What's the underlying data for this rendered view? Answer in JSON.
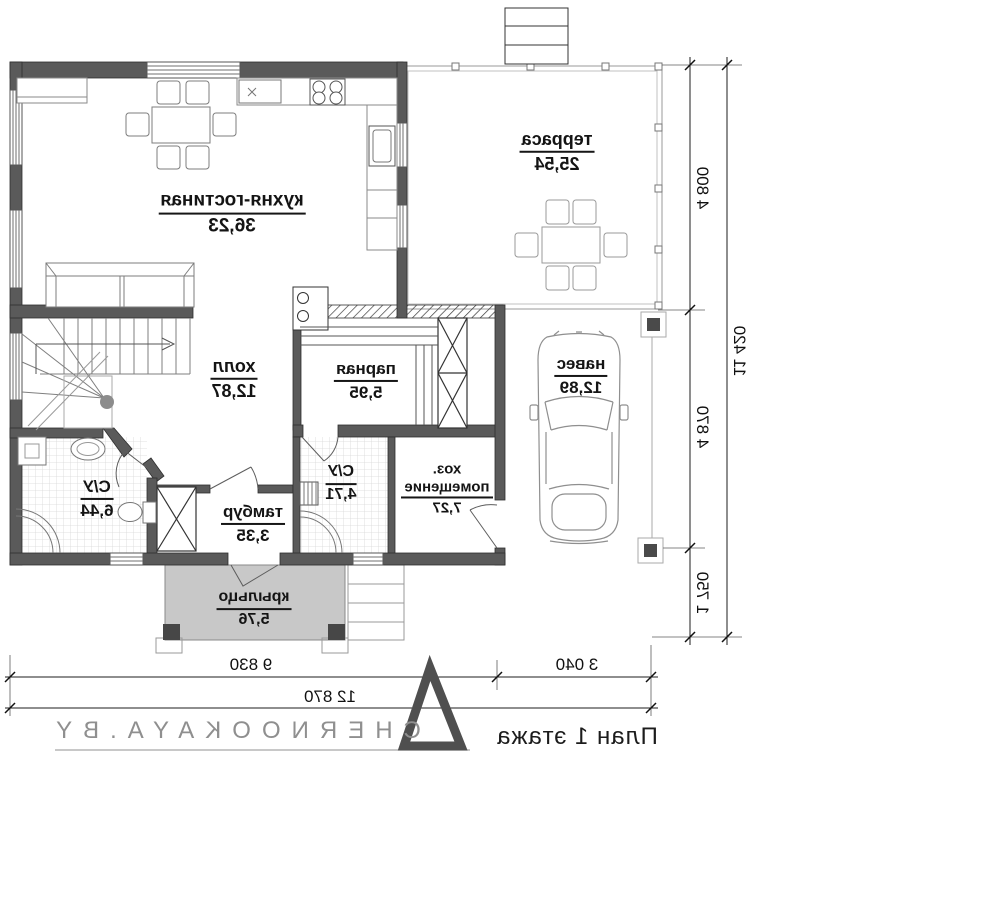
{
  "plan": {
    "title": "План 1 этажа",
    "branding": {
      "logo_text": "CHERNOOKAYA.BY"
    },
    "rooms": [
      {
        "id": "kitchen-living",
        "name": "кухня-гостиная",
        "area": "36,23"
      },
      {
        "id": "terrace",
        "name": "терраса",
        "area": "25,54"
      },
      {
        "id": "hall",
        "name": "холл",
        "area": "12,87"
      },
      {
        "id": "sauna",
        "name": "парная",
        "area": "5,95"
      },
      {
        "id": "carport",
        "name": "навес",
        "area": "12,89"
      },
      {
        "id": "bathroom-1",
        "name": "С/У",
        "area": "6,44"
      },
      {
        "id": "bathroom-2",
        "name": "С/У",
        "area": "4,71"
      },
      {
        "id": "vestibule",
        "name": "тамбур",
        "area": "3,35"
      },
      {
        "id": "utility",
        "name": "хоз. помещение",
        "area": "7,27"
      },
      {
        "id": "porch",
        "name": "крыльцо",
        "area": "5,76"
      }
    ],
    "dimensions": {
      "vertical": [
        {
          "label": "4 800"
        },
        {
          "label": "4 870"
        },
        {
          "label": "1 750"
        },
        {
          "label": "11 420"
        }
      ],
      "horizontal": [
        {
          "label": "9 830"
        },
        {
          "label": "3 040"
        },
        {
          "label": "12 870"
        }
      ]
    }
  }
}
